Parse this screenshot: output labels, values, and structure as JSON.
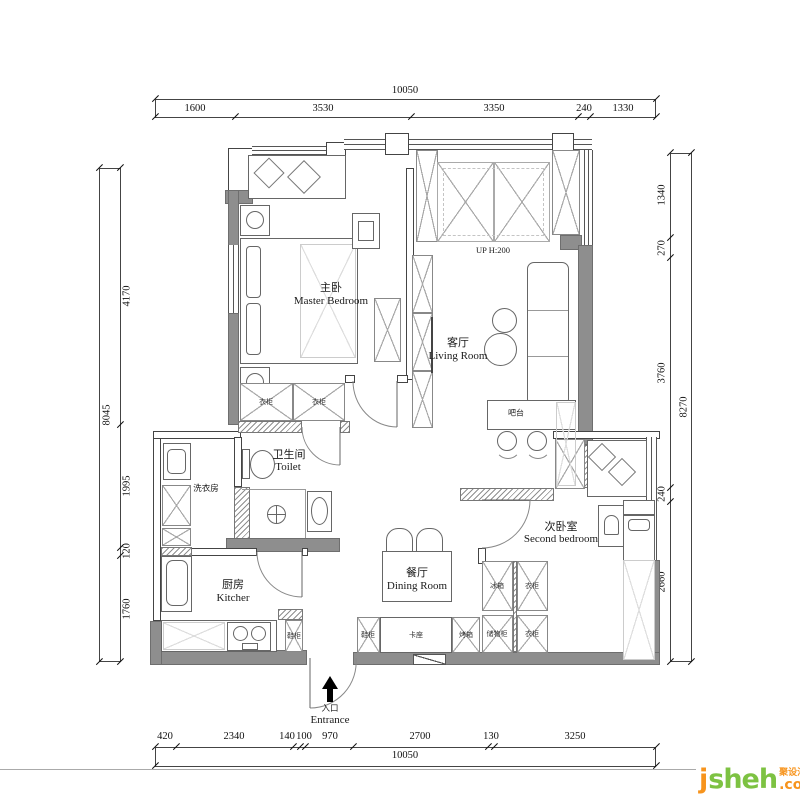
{
  "dimensions": {
    "top": {
      "total": "10050",
      "segments": [
        "1600",
        "3530",
        "3350",
        "240",
        "1330"
      ]
    },
    "bottom": {
      "total": "10050",
      "segments": [
        "420",
        "2340",
        "140",
        "100",
        "970",
        "2700",
        "130",
        "3250"
      ]
    },
    "left": {
      "total": "8045",
      "segments": [
        "4170",
        "1995",
        "120",
        "1760"
      ]
    },
    "right": {
      "total": "8270",
      "segments": [
        "1340",
        "270",
        "3760",
        "240",
        "2660"
      ]
    }
  },
  "rooms": {
    "master_bedroom": {
      "zh": "主卧",
      "en": "Master Bedroom"
    },
    "living_room": {
      "zh": "客厅",
      "en": "Living Room"
    },
    "toilet": {
      "zh": "卫生间",
      "en": "Toilet"
    },
    "laundry": {
      "zh": "洗衣房"
    },
    "kitchen": {
      "zh": "厨房",
      "en": "Kitcher"
    },
    "dining_room": {
      "zh": "餐厅",
      "en": "Dining Room"
    },
    "second_bedroom": {
      "zh": "次卧室",
      "en": "Second bedroom"
    }
  },
  "labels": {
    "up_platform": "UP H:200",
    "bar_counter": "吧台",
    "entrance": {
      "zh": "入口",
      "en": "Entrance"
    },
    "wardrobe": "衣柜",
    "shoe_cabinet": "鞋柜",
    "booth_seat": "卡座",
    "oven": "烤箱",
    "storage_cabinet": "储物柜",
    "fridge": "冰箱"
  },
  "logo": {
    "first_letter": "j",
    "rest": "sheh",
    "tld": ".com",
    "tagline": "聚设汇"
  },
  "colors": {
    "wall_fill": "#8e8e8e",
    "line": "#444444",
    "logo_orange": "#f7941d",
    "logo_green": "#7dc242"
  }
}
